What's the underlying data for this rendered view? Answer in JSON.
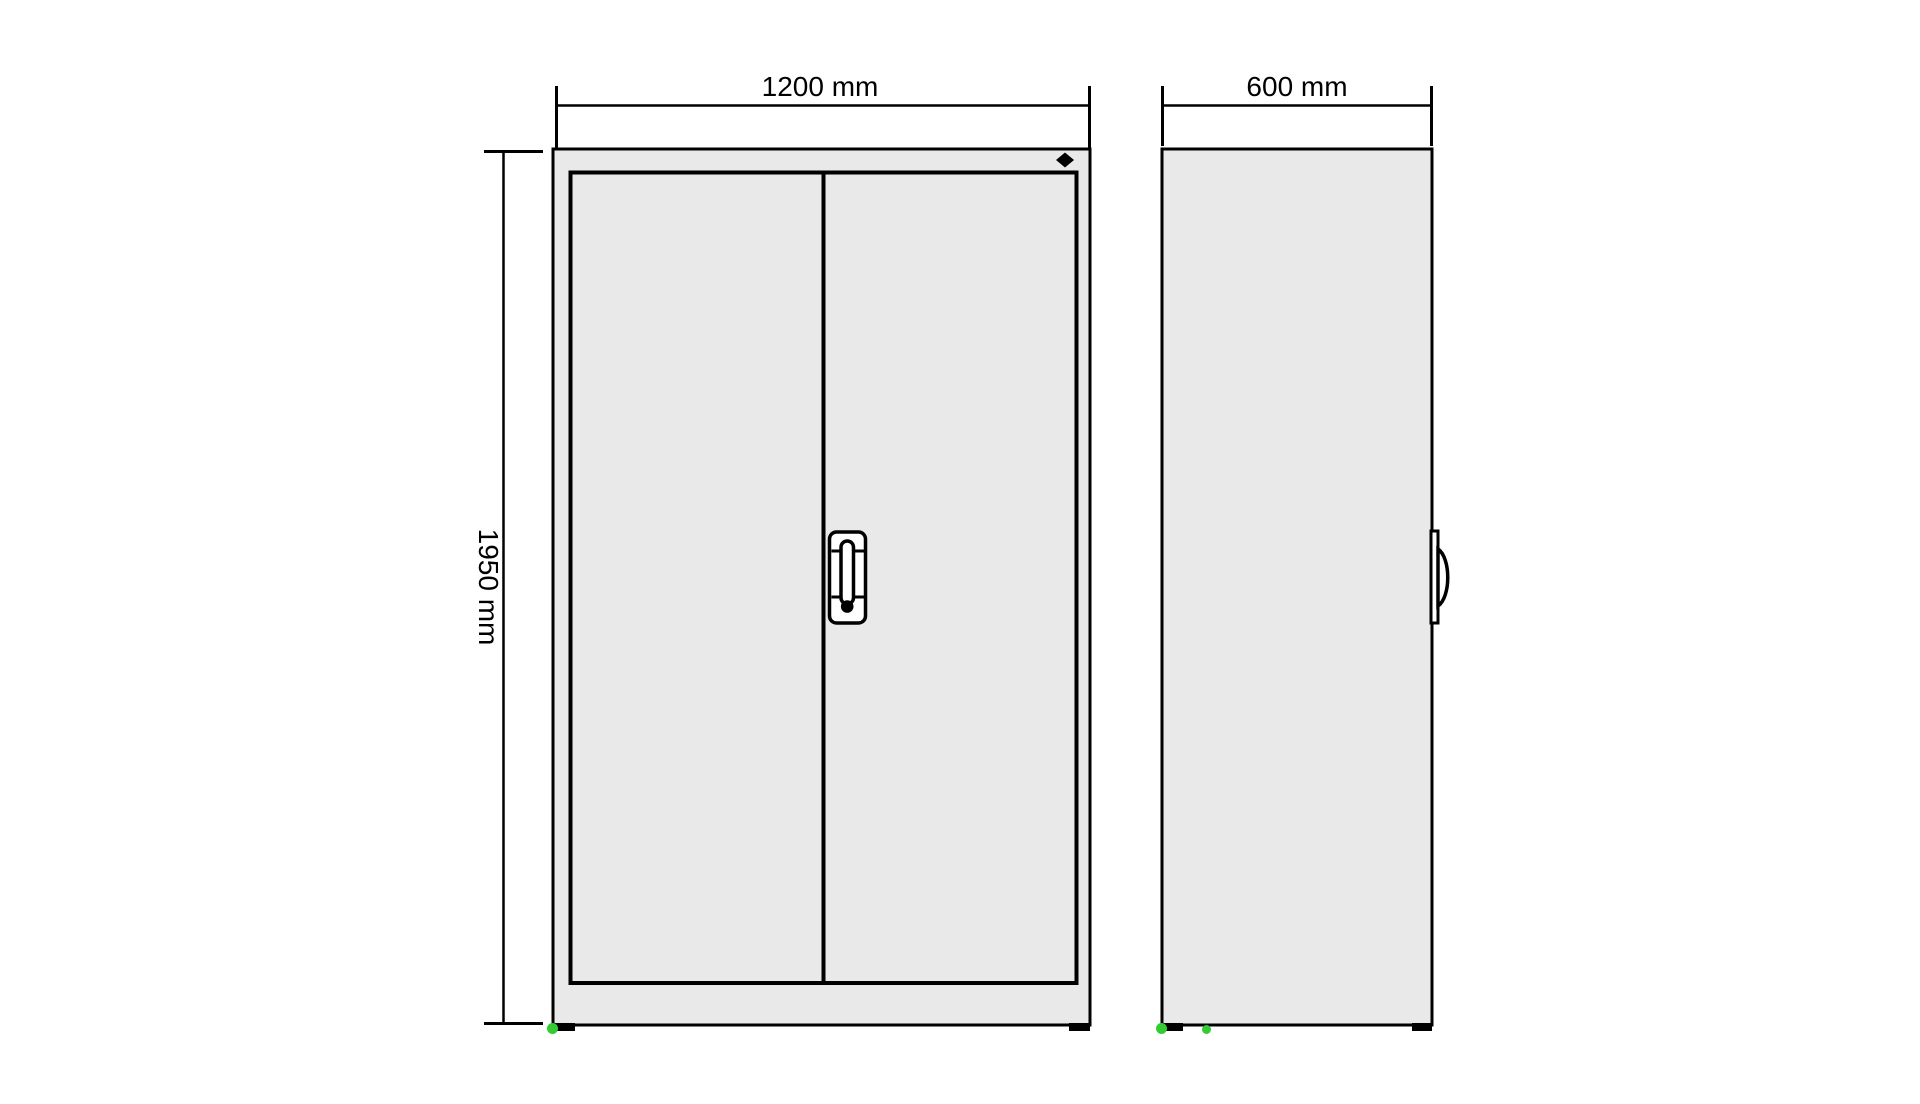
{
  "drawing": {
    "type": "furniture-dimension-drawing",
    "subject": "two-door cabinet, front and side orthographic views",
    "dimensions": {
      "width": {
        "label": "1200 mm",
        "value_mm": 1200,
        "orientation": "horizontal",
        "applies_to": "front-view"
      },
      "height": {
        "label": "1950 mm",
        "value_mm": 1950,
        "orientation": "vertical",
        "applies_to": "front-view"
      },
      "depth": {
        "label": "600 mm",
        "value_mm": 600,
        "orientation": "horizontal",
        "applies_to": "side-view"
      }
    },
    "colors": {
      "background": "#ffffff",
      "cabinet_fill": "#e9e9e9",
      "line": "#000000",
      "handle_fill": "#ffffff",
      "foot_marker_green": "#33cc33",
      "foot_black": "#000000"
    }
  }
}
